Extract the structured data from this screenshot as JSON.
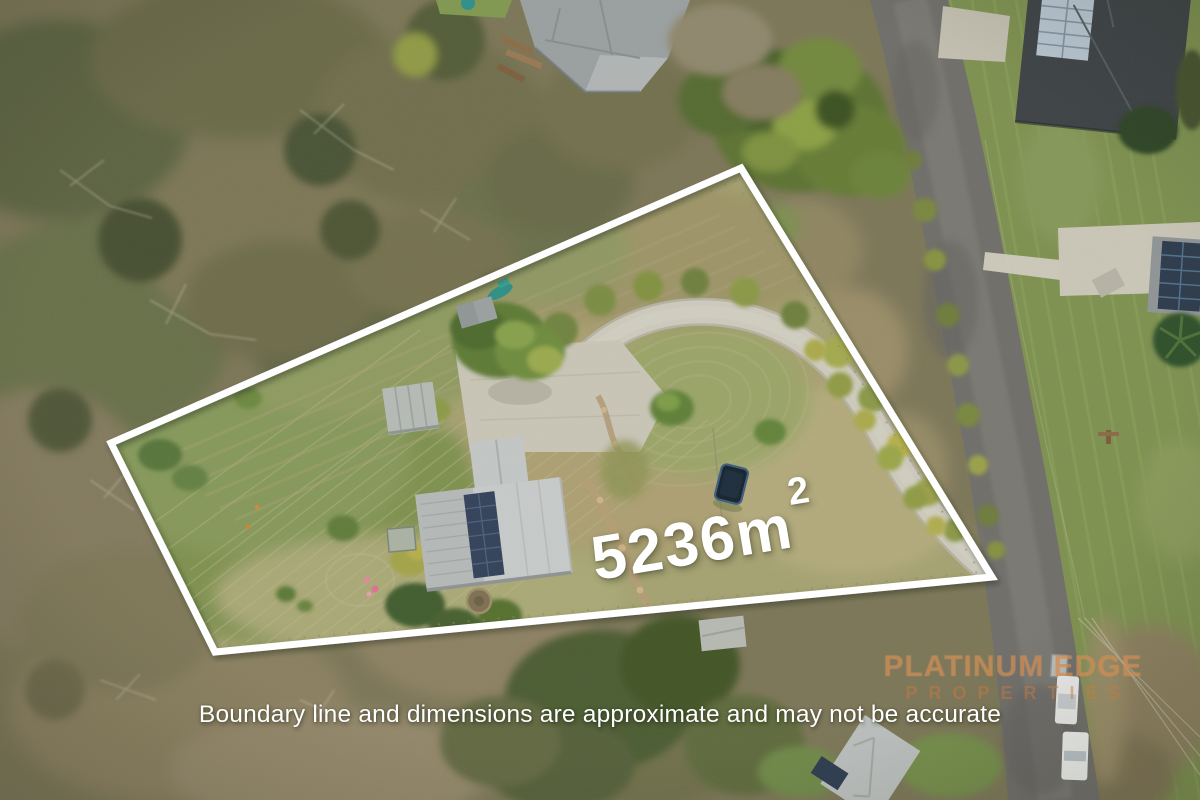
{
  "overlay": {
    "area_label": {
      "value": "5236m",
      "superscript": "2"
    },
    "disclaimer": "Boundary line and dimensions are approximate and may not be accurate",
    "watermark": {
      "line1": "PLATINUM EDGE",
      "line2": "PROPERTIES",
      "color": "#c77a3e"
    },
    "boundary_line": {
      "color": "#ffffff",
      "points": "741,168 992,577 215,652 111,443"
    }
  },
  "scene": {
    "type": "aerial-drone-photograph",
    "features": [
      "semi-rural property outlined by white boundary line",
      "house with grey metal roof and solar panels",
      "detached shed and small outbuildings",
      "looping concrete driveway to road",
      "trampoline, boat with teal cover, round water tank",
      "mowed paddock with mower lines",
      "surrounding dry bushland with dead branches",
      "asphalt road with white vehicles and neighbouring solar-roofed houses"
    ]
  }
}
